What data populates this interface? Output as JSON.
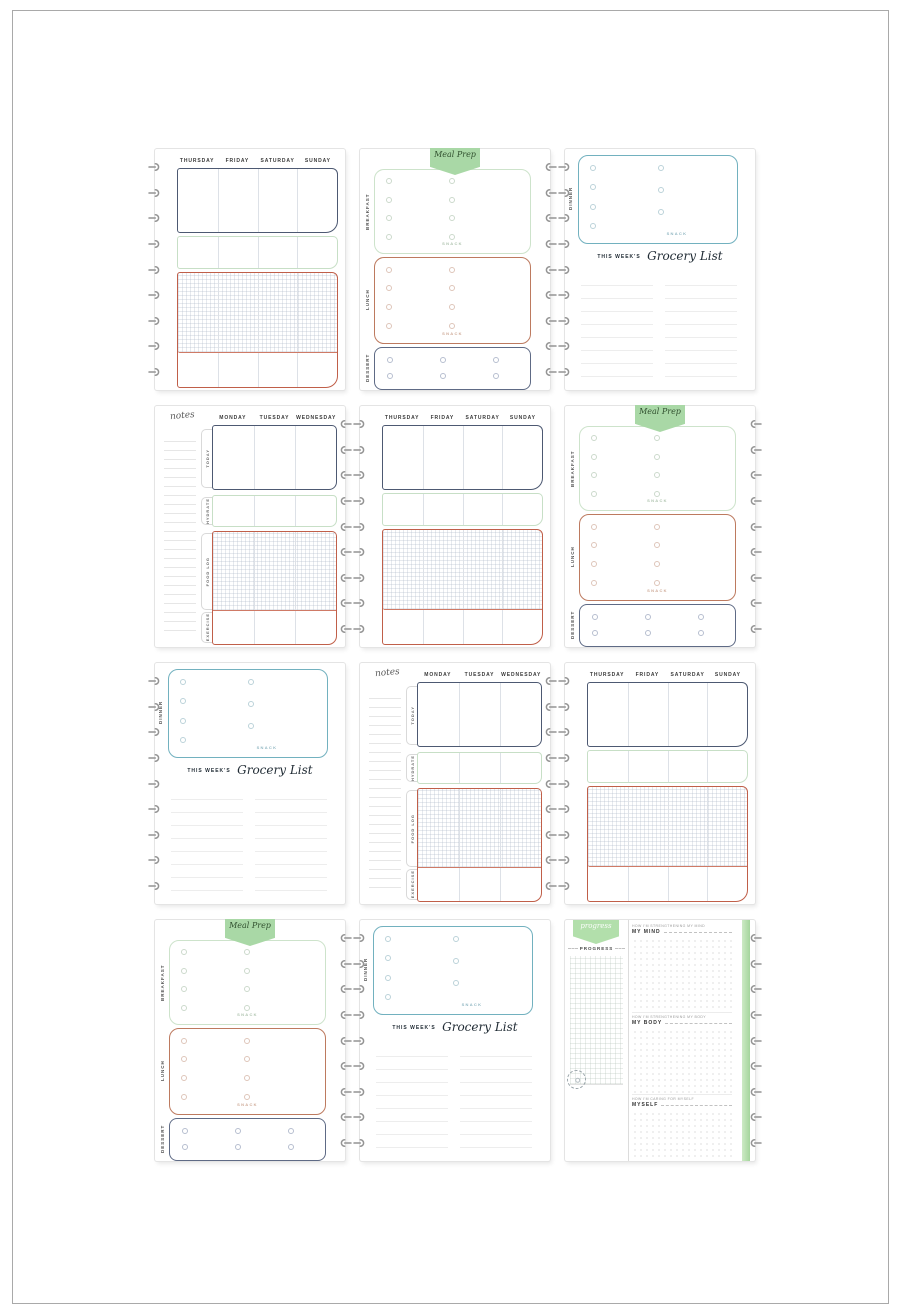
{
  "colors": {
    "frame_border": "#a9a9a9",
    "navy_box": "#4d5972",
    "green_box": "#c7dfc6",
    "green_banner": "#a9d8a6",
    "red_box": "#c05f49",
    "teal_box": "#72b1bf",
    "hole_gray": "#949494",
    "edge_strip_green": "#aede9f"
  },
  "days": {
    "thu_sun": [
      "THURSDAY",
      "FRIDAY",
      "SATURDAY",
      "SUNDAY"
    ],
    "mon_wed": [
      "MONDAY",
      "TUESDAY",
      "WEDNESDAY"
    ]
  },
  "labels": {
    "meal_prep": "Meal Prep",
    "breakfast": "BREAKFAST",
    "lunch": "LUNCH",
    "dessert": "DESSERT",
    "dinner": "DINNER",
    "snack": "SNACK",
    "grocery_prefix": "THIS WEEK'S",
    "grocery_title": "Grocery List",
    "notes": "notes",
    "today": "TODAY",
    "hydrate": "HYDRATE",
    "food_log": "FOOD LOG",
    "exercise": "EXERCISE",
    "progress_script": "progress",
    "progress": "PROGRESS",
    "mind_caption": "HOW I'M STRENGTHENING MY MIND",
    "mind_label": "MY MIND",
    "body_caption": "HOW I'M STRENGTHENING MY BODY",
    "body_label": "MY BODY",
    "myself_caption": "HOW I'M CARING FOR MYSELF",
    "myself_label": "MYSELF"
  },
  "pages": [
    {
      "slot": 1,
      "type": "weekly-thu-sun"
    },
    {
      "slot": 2,
      "type": "meal-prep"
    },
    {
      "slot": 3,
      "type": "dinner-grocery-list"
    },
    {
      "slot": 4,
      "type": "notes-mon-wed"
    },
    {
      "slot": 5,
      "type": "weekly-thu-sun"
    },
    {
      "slot": 6,
      "type": "meal-prep"
    },
    {
      "slot": 7,
      "type": "dinner-grocery-list"
    },
    {
      "slot": 8,
      "type": "notes-mon-wed"
    },
    {
      "slot": 9,
      "type": "weekly-thu-sun"
    },
    {
      "slot": 10,
      "type": "meal-prep"
    },
    {
      "slot": 11,
      "type": "dinner-grocery-list"
    },
    {
      "slot": 12,
      "type": "progress"
    }
  ]
}
